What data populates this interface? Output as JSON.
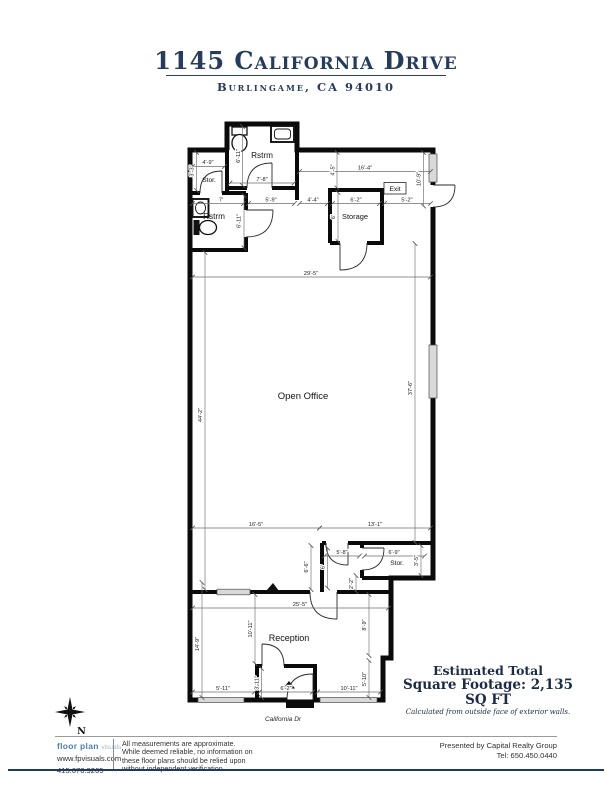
{
  "title": {
    "address": "1145 California Drive",
    "city": "Burlingame, CA 94010"
  },
  "plan": {
    "rooms": {
      "rstrm_top": "Rstrm",
      "stor_top": "Stor.",
      "rstrm_left": "Rstrm",
      "storage": "Storage",
      "open_office": "Open Office",
      "stor_right": "Stor.",
      "reception": "Reception"
    },
    "exit": "Exit",
    "street": "California Dr",
    "north": "N",
    "dims": {
      "stor_top_w": "4'-9\"",
      "stor_top_h": "3'-3\"",
      "rstrm_top_h": "6'-11\"",
      "rstrm_top_w": "7'-8\"",
      "hall_top_h": "4'-5\"",
      "hall_top_w": "16'-4\"",
      "right_top_h": "10'-9\"",
      "rstrm_left_w": "7'",
      "rstrm_left_door_w": "5'-9\"",
      "hall_gap_w": "4'-4\"",
      "storage_w": "6'-2\"",
      "exit_bay_w": "5'-2\"",
      "rstrm_left_h": "6'-11\"",
      "storage_h": "6'",
      "office_w": "29'-5\"",
      "office_h_left": "44'-2\"",
      "office_h_right": "37'-6\"",
      "lower_left_w": "16'-5\"",
      "lower_right_w": "13'-1\"",
      "mid_room_w": "5'-8\"",
      "stor_right_w": "6'-9\"",
      "stor_right_h": "3'-5\"",
      "mid_room_h": "6'-6\"",
      "mid_room_door_h": "6'",
      "step_h": "2'-2\"",
      "reception_w": "25'-5\"",
      "reception_left_h": "14'-9\"",
      "reception_mid_h": "10'-11\"",
      "reception_right_h": "8'-9\"",
      "reception_right_h2": "5'-10\"",
      "entry_left_w": "5'-11\"",
      "vestibule_h": "3'-11\"",
      "vestibule_w": "6'-2\"",
      "entry_right_w": "10'-11\""
    }
  },
  "summary": {
    "line1": "Estimated Total",
    "line2": "Square Footage: 2,135 SQ FT",
    "note": "Calculated from outside face of exterior walls."
  },
  "footer": {
    "brand": "floor plan",
    "brand_light": "visuals",
    "website": "www.fpvisuals.com",
    "phone": "415.670.9265",
    "disclaimer": "All measurements are approximate. While deemed reliable, no information on these floor plans should be relied upon without independent verification.",
    "presented_by": "Presented by Capital Realty Group",
    "tel": "Tel: 650.450.0440"
  }
}
